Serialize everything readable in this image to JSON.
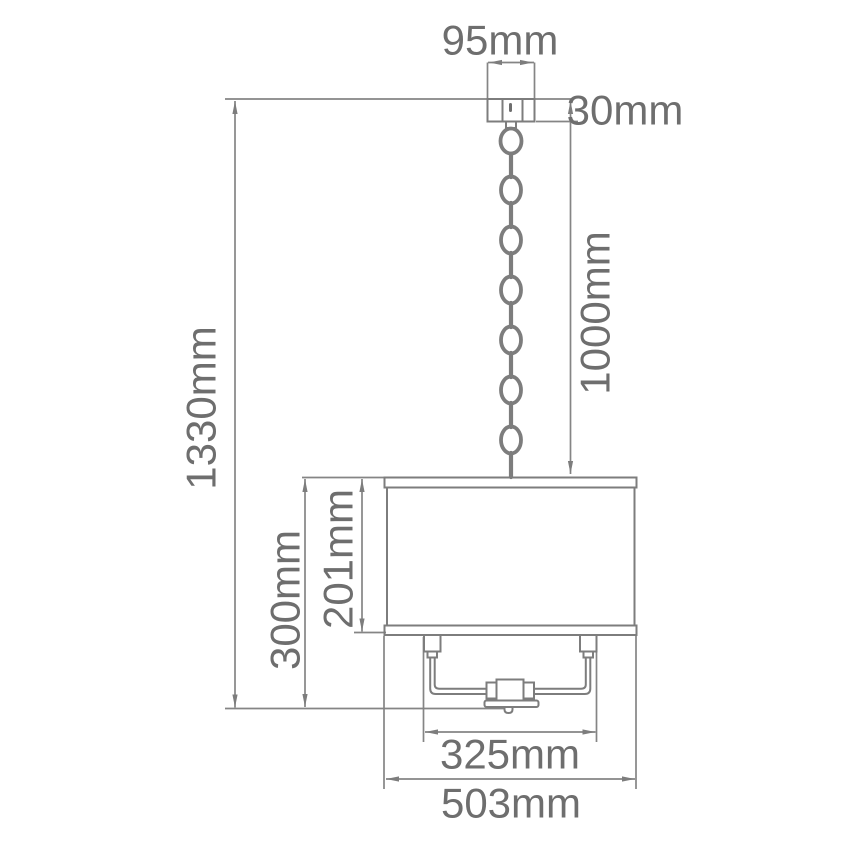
{
  "drawing": {
    "type": "pendant-light-dimension-diagram",
    "unit": "mm",
    "background": "#ffffff",
    "line_color": "#7d7d7d",
    "text_color": "#6e6e6e",
    "labels": {
      "canopy_width": "95mm",
      "canopy_height": "30mm",
      "chain_length": "1000mm",
      "overall_height": "1330mm",
      "body_height": "300mm",
      "shade_height": "201mm",
      "frame_width": "325mm",
      "shade_width": "503mm"
    },
    "dimensions_mm": {
      "canopy_width": 95,
      "canopy_height": 30,
      "chain_length": 1000,
      "overall_height": 1330,
      "body_height": 300,
      "shade_height": 201,
      "frame_width": 325,
      "shade_width": 503
    }
  }
}
